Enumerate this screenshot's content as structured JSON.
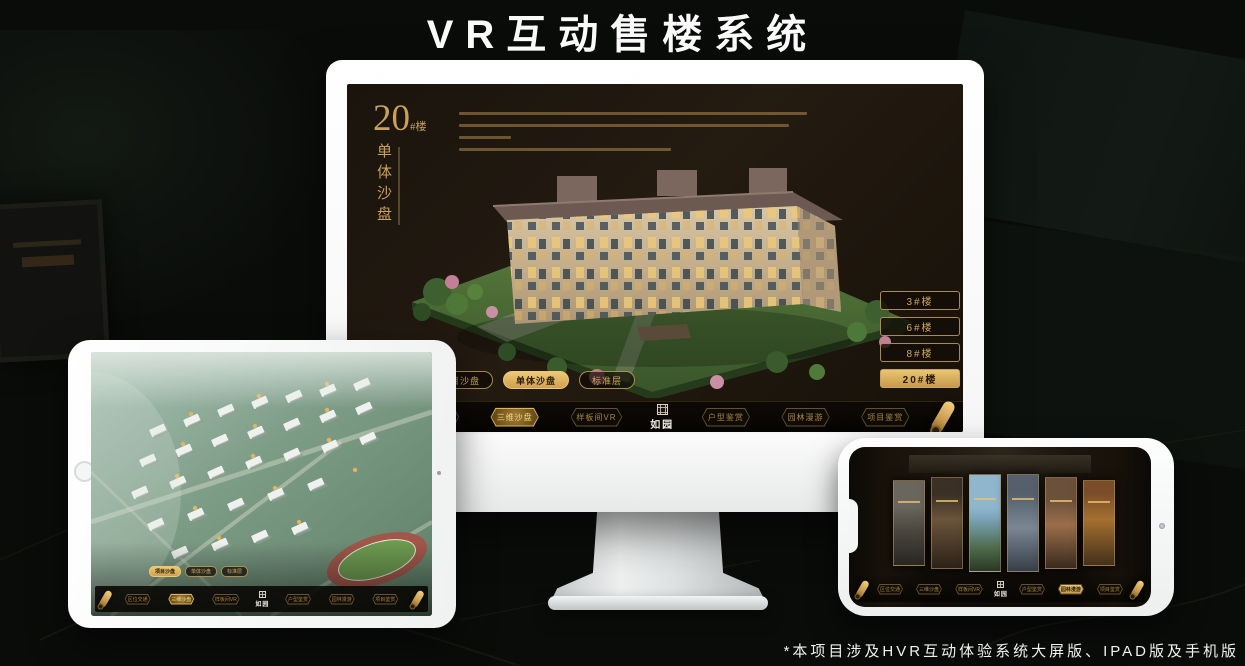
{
  "page": {
    "title": "VR互动售楼系统",
    "footnote": "*本项目涉及HVR互动体验系统大屏版、IPAD版及手机版"
  },
  "app": {
    "logo": "如园",
    "nav_items": [
      {
        "label": "区位交通"
      },
      {
        "label": "三维沙盘"
      },
      {
        "label": "样板间VR"
      },
      {
        "label": "户型鉴赏"
      },
      {
        "label": "园林漫游"
      },
      {
        "label": "项目鉴赏"
      }
    ],
    "view_tabs": [
      {
        "label": "项目沙盘"
      },
      {
        "label": "单体沙盘"
      },
      {
        "label": "标准层"
      }
    ],
    "accent_gold": "#c9a15a"
  },
  "monitor_screen": {
    "heading_number": "20",
    "heading_unit": "#楼",
    "heading_vertical": "单体沙盘",
    "floor_buttons": [
      {
        "label": "3#楼"
      },
      {
        "label": "6#楼"
      },
      {
        "label": "8#楼"
      },
      {
        "label": "20#楼"
      }
    ],
    "active_floor": "20#楼",
    "active_view_tab": "单体沙盘",
    "active_nav": "三维沙盘"
  },
  "tablet_screen": {
    "active_view_tab": "项目沙盘",
    "active_nav": "三维沙盘"
  },
  "phone_screen": {
    "active_nav": "园林漫游",
    "gallery_panel_count": 6
  }
}
